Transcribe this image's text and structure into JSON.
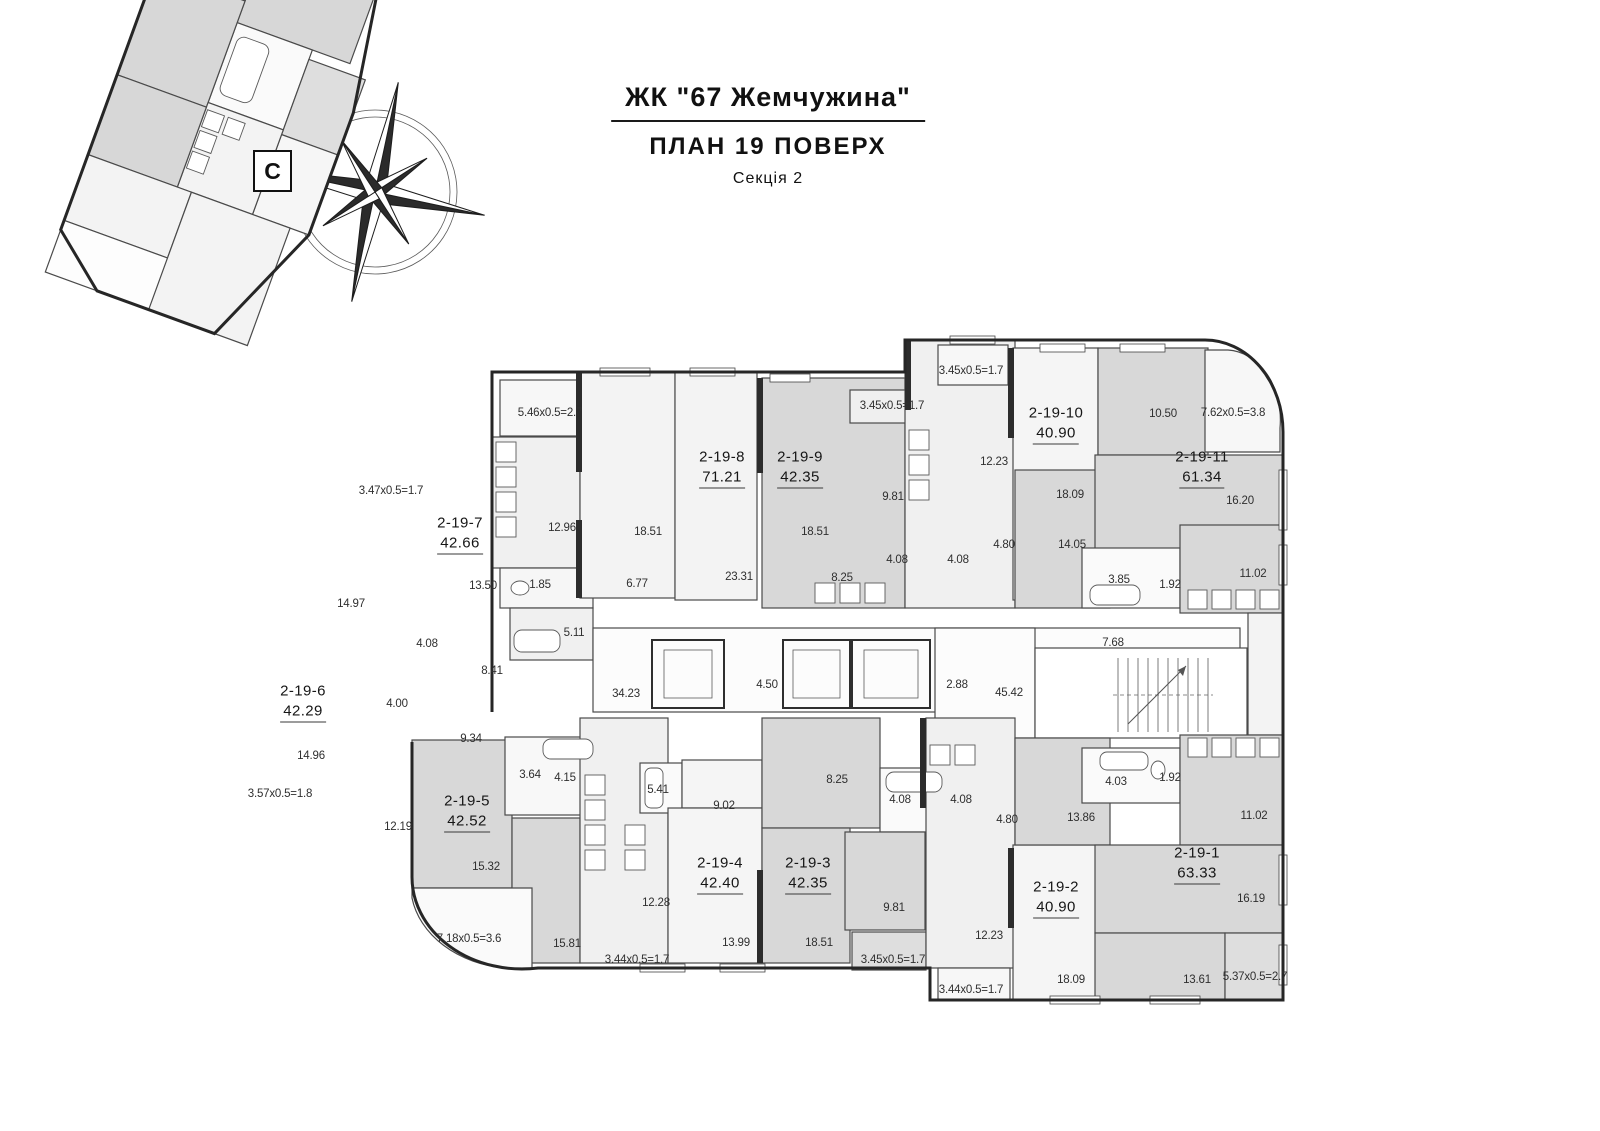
{
  "title": {
    "complex": "ЖК \"67 Жемчужина\"",
    "plan": "ПЛАН 19 ПОВЕРХ",
    "section": "Секція 2"
  },
  "compass": {
    "north": "С"
  },
  "apartments": [
    {
      "id": "2-19-7",
      "area": "42.66"
    },
    {
      "id": "2-19-8",
      "area": "71.21"
    },
    {
      "id": "2-19-9",
      "area": "42.35"
    },
    {
      "id": "2-19-10",
      "area": "40.90"
    },
    {
      "id": "2-19-11",
      "area": "61.34"
    },
    {
      "id": "2-19-6",
      "area": "42.29"
    },
    {
      "id": "2-19-5",
      "area": "42.52"
    },
    {
      "id": "2-19-4",
      "area": "42.40"
    },
    {
      "id": "2-19-3",
      "area": "42.35"
    },
    {
      "id": "2-19-2",
      "area": "40.90"
    },
    {
      "id": "2-19-1",
      "area": "63.33"
    }
  ],
  "dims": [
    "5.46x0.5=2.7",
    "12.96",
    "1.85",
    "5.11",
    "18.51",
    "6.77",
    "23.31",
    "18.51",
    "8.25",
    "3.45x0.5=1.7",
    "3.45x0.5=1.7",
    "9.81",
    "12.23",
    "4.08",
    "4.08",
    "4.80",
    "18.09",
    "14.05",
    "10.50",
    "7.62x0.5=3.8",
    "16.20",
    "3.85",
    "1.92",
    "11.02",
    "7.68",
    "34.23",
    "4.50",
    "2.88",
    "45.42",
    "3.47x0.5=1.7",
    "13.50",
    "14.97",
    "4.08",
    "8.41",
    "4.00",
    "9.34",
    "14.96",
    "3.57x0.5=1.8",
    "12.19",
    "3.64",
    "4.15",
    "5.41",
    "9.02",
    "8.25",
    "15.32",
    "12.28",
    "7.18x0.5=3.6",
    "15.81",
    "13.99",
    "18.51",
    "3.44x0.5=1.7",
    "4.08",
    "4.08",
    "4.80",
    "9.81",
    "12.23",
    "3.45x0.5=1.7",
    "3.44x0.5=1.7",
    "18.09",
    "13.86",
    "4.03",
    "1.92",
    "11.02",
    "16.19",
    "13.61",
    "5.37x0.5=2.7"
  ]
}
